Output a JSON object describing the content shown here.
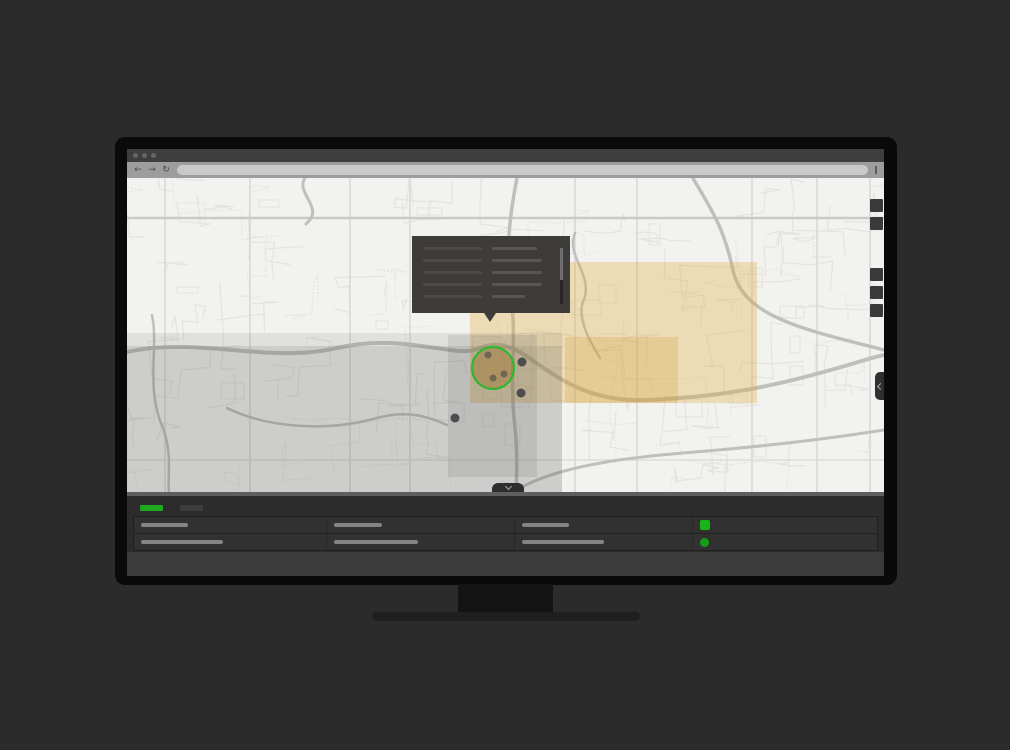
{
  "browser": {
    "window_controls": [
      "close",
      "minimize",
      "maximize"
    ],
    "toolbar": {
      "back_icon": "←",
      "forward_icon": "→",
      "refresh_icon": "↻",
      "url_value": "",
      "menu_icon": "kebab-dash"
    }
  },
  "map": {
    "colors": {
      "background": "#f2f2f0",
      "road_minor": "#e4e3e1",
      "road_major": "#d9d8d6",
      "highway": "#bfbfbd",
      "zone_gray": "rgba(70,70,70,0.12)",
      "zone_tan": "rgba(225,170,55,0.32)",
      "zone_tan_dark": "rgba(205,145,35,0.22)",
      "cluster_ring": "#2eb82e",
      "cluster_fill": "rgba(160,115,45,0.45)",
      "cluster_dot": "#6f6753",
      "marker": "#4d4d4d"
    },
    "cluster": {
      "point_count": 3
    },
    "marker_count": 3,
    "controls": {
      "top_group_count": 2,
      "bottom_group_count": 3
    },
    "side_tab_icon": "chevron-left",
    "panel_toggle_icon": "chevron-down"
  },
  "tooltip": {
    "left_bar_widths": [
      59,
      59,
      59,
      59,
      59
    ],
    "right_bar_widths": [
      45,
      50,
      50,
      50,
      33
    ]
  },
  "panel": {
    "tabs": [
      {
        "state": "active",
        "color": "#1fa81f"
      },
      {
        "state": "inactive",
        "color": "#3d3d3d"
      }
    ],
    "table": {
      "rows": [
        {
          "bars": [
            47,
            48,
            47
          ],
          "indicator": {
            "shape": "square",
            "color": "#17b517"
          }
        },
        {
          "bars": [
            82,
            84,
            82
          ],
          "indicator": {
            "shape": "circle",
            "color": "#149e14"
          }
        }
      ]
    }
  }
}
